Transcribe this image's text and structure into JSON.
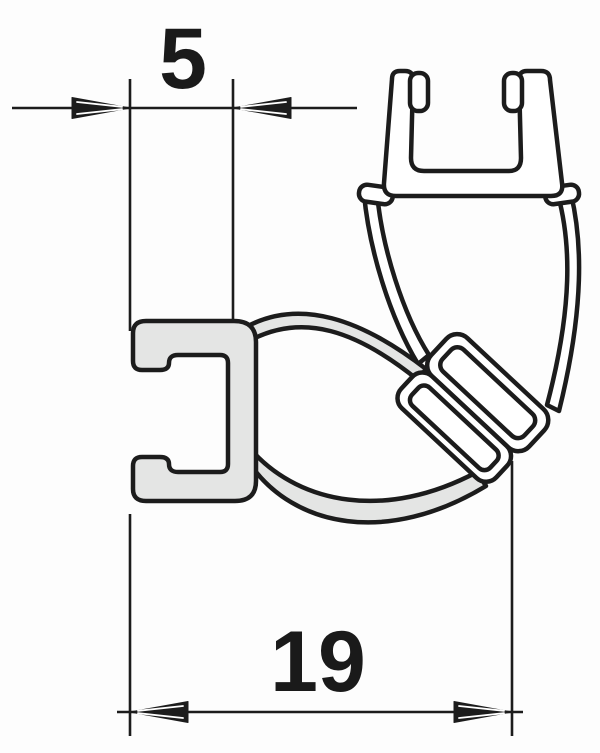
{
  "figure": {
    "kind": "technical cross-section diagram",
    "colors": {
      "line": "#1c1c1c",
      "highlighted_profile_fill": "#e4e5e4",
      "counter_profile_fill": "#ffffff",
      "background": "#fdfdfd",
      "dimension_text": "#1a1a1a"
    },
    "dimensions": [
      {
        "id": "channel-depth",
        "label": "5",
        "orientation": "horizontal",
        "position": "top-left",
        "arrow_style": "inward-striped"
      },
      {
        "id": "overall-depth",
        "label": "19",
        "orientation": "horizontal",
        "position": "bottom",
        "arrow_style": "outward-striped"
      }
    ],
    "parts": [
      {
        "name": "left-glass-channel",
        "fill": "gray"
      },
      {
        "name": "top-glass-channel",
        "fill": "white"
      },
      {
        "name": "seal-bulb",
        "fill": "white"
      },
      {
        "name": "upper-seal-arc",
        "fill": "gray"
      },
      {
        "name": "lower-seal-arc",
        "fill": "gray"
      },
      {
        "name": "magnet-block",
        "fill": "white"
      }
    ]
  }
}
